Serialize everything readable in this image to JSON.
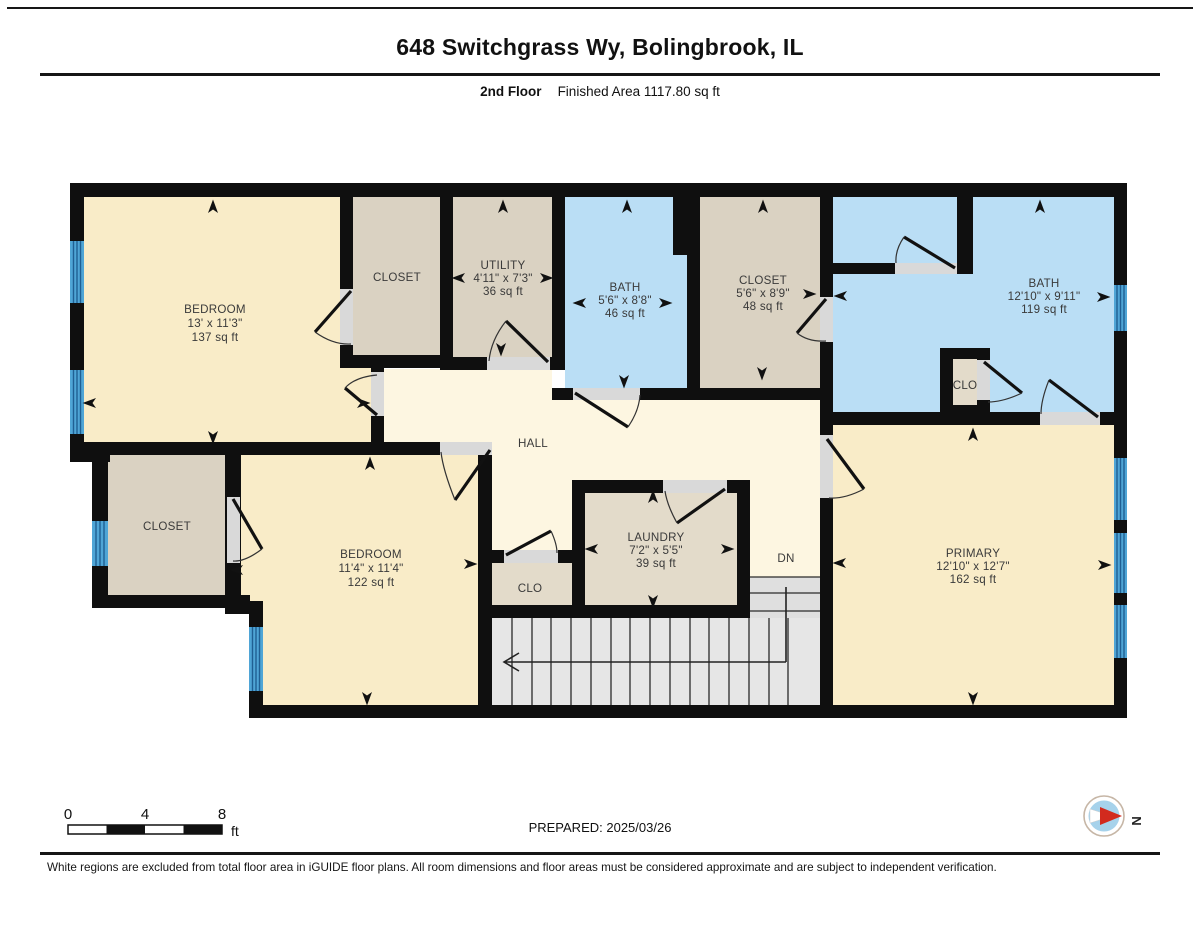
{
  "header": {
    "title": "648 Switchgrass Wy, Bolingbrook, IL",
    "floor_label": "2nd Floor",
    "area_label": "Finished Area 1117.80 sq ft"
  },
  "rooms": {
    "bedroom1": {
      "name": "BEDROOM",
      "dims": "13' x 11'3\"",
      "area": "137 sq ft"
    },
    "closet_top": {
      "name": "CLOSET"
    },
    "utility": {
      "name": "UTILITY",
      "dims": "4'11\" x 7'3\"",
      "area": "36 sq ft"
    },
    "bath2": {
      "name": "BATH",
      "dims": "5'6\" x 8'8\"",
      "area": "46 sq ft"
    },
    "closet_primary": {
      "name": "CLOSET",
      "dims": "5'6\" x 8'9\"",
      "area": "48 sq ft"
    },
    "bath_primary": {
      "name": "BATH",
      "dims": "12'10\" x 9'11\"",
      "area": "119 sq ft"
    },
    "clo_bath": {
      "name": "CLO"
    },
    "hall": {
      "name": "HALL"
    },
    "closet_left": {
      "name": "CLOSET"
    },
    "bedroom2": {
      "name": "BEDROOM",
      "dims": "11'4\" x 11'4\"",
      "area": "122 sq ft"
    },
    "clo_hall": {
      "name": "CLO"
    },
    "laundry": {
      "name": "LAUNDRY",
      "dims": "7'2\" x 5'5\"",
      "area": "39 sq ft"
    },
    "stairs": {
      "label": "DN"
    },
    "primary": {
      "name": "PRIMARY",
      "dims": "12'10\" x 12'7\"",
      "area": "162 sq ft"
    }
  },
  "scale_bar": {
    "ticks": [
      "0",
      "4",
      "8"
    ],
    "unit": "ft"
  },
  "prepared_label": "PREPARED: 2025/03/26",
  "compass": {
    "north_label": "N"
  },
  "footer": {
    "disclaimer": "White regions are excluded from total floor area in iGUIDE floor plans. All room dimensions and floor areas must be considered approximate and are subject to independent verification."
  },
  "colors": {
    "room_cream": "#f9ecc8",
    "room_tan": "#dad2c2",
    "room_tan_light": "#e3dbca",
    "room_blue": "#badef5",
    "hall_cream": "#fdf6e1",
    "wall_black": "#0f0f0f",
    "window_blue": "#4fa5d6",
    "stair_gray": "#e6e6e6",
    "compass_blue": "#a6d2eb",
    "compass_red": "#d22a1e"
  }
}
